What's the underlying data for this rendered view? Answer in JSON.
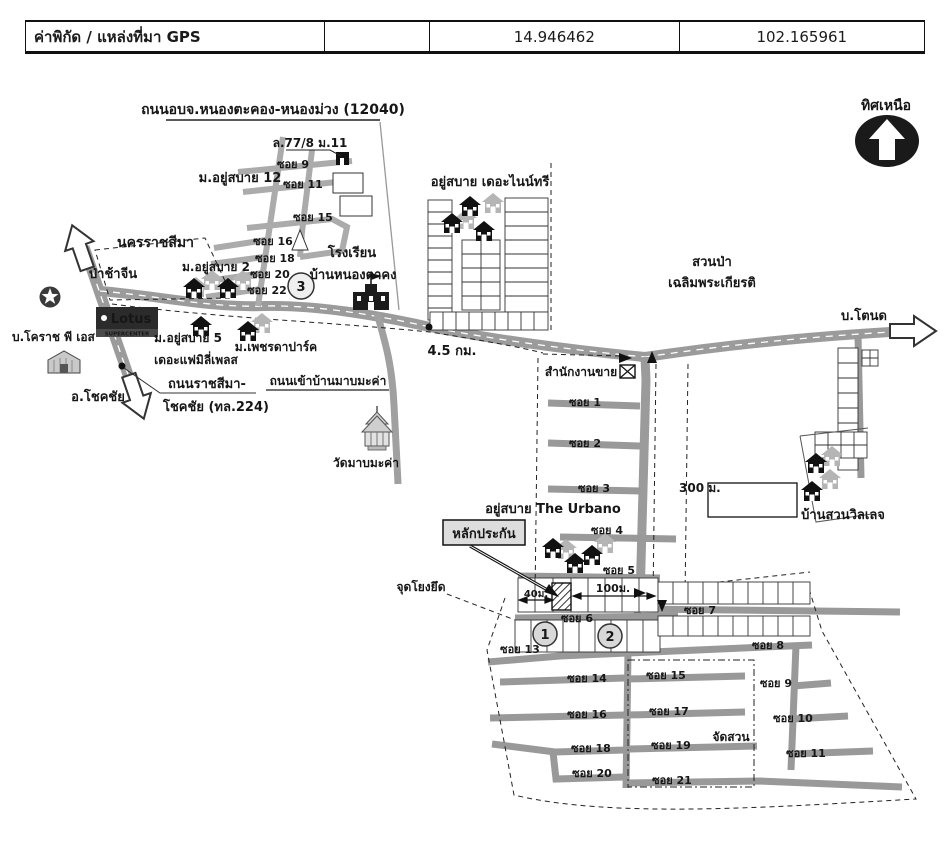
{
  "header": {
    "col1": "ค่าพิกัด / แหล่งที่มา GPS",
    "col2": "",
    "col3": "14.946462",
    "col4": "102.165961"
  },
  "compass": {
    "label": "ทิศเหนือ"
  },
  "roads": {
    "top_road": "ถนนอบจ.หนองตะคอง-หนองม่วง (12040)",
    "highway_label_1": "ถนนราชสีมา-",
    "highway_label_2": "โชคชัย (ทล.224)",
    "makha_entry": "ถนนเข้าบ้านมาบมะค่า"
  },
  "destinations": {
    "north_west": "นครราชสีมา",
    "south": "อ.โชคชัย",
    "east": "บ.โตนด"
  },
  "places": {
    "house_77": "ล.77/8 ม.11",
    "moo12": "ม.อยู่สบาย 12",
    "school_line1": "โรงเรียน",
    "school_line2": "บ้านหนองตาคง",
    "cemetery": "ป่าช้าจีน",
    "moo2": "ม.อยู่สบาย 2",
    "lotus": "Lotus",
    "lotus_sub": "SUPERCENTER",
    "korat_ps": "บ.โคราช พี เอส",
    "moo5_line1": "ม.อยู่สบาย 5",
    "moo5_line2": "เดอะแฟมิลี่เพลส",
    "phetda": "ม.เพชรดาปาร์ค",
    "wat": "วัดมาบมะค่า",
    "ninetree": "อยู่สบาย เดอะไนน์ทรี",
    "forest_line1": "สวนป่า",
    "forest_line2": "เฉลิมพระเกียรติ",
    "sales_office": "สำนักงานขาย",
    "urbano": "อยู่สบาย The Urbano",
    "collateral": "หลักประกัน",
    "anchor_point": "จุดโยงยึด",
    "garden": "จัดสวน",
    "baan_suan": "บ้านสวนวิลเลจ"
  },
  "distances": {
    "km45": "4.5 กม.",
    "m300": "300 ม.",
    "m40": "40ม.",
    "m100": "100ม."
  },
  "markers": {
    "n1": "1",
    "n2": "2",
    "n3": "3"
  },
  "sois": {
    "top": {
      "s9": "ซอย 9",
      "s11": "ซอย 11",
      "s15": "ซอย 15",
      "s16": "ซอย 16",
      "s18": "ซอย 18",
      "s20": "ซอย 20",
      "s22": "ซอย 22"
    },
    "mid": {
      "s1": "ซอย 1",
      "s2": "ซอย 2",
      "s3": "ซอย 3",
      "s4": "ซอย 4",
      "s5": "ซอย 5",
      "s6": "ซอย 6",
      "s7": "ซอย 7",
      "s8": "ซอย 8"
    },
    "bottom": {
      "s13": "ซอย 13",
      "s14": "ซอย 14",
      "s15": "ซอย 15",
      "s16": "ซอย 16",
      "s17": "ซอย 17",
      "s18": "ซอย 18",
      "s19": "ซอย 19",
      "s20": "ซอย 20",
      "s21": "ซอย 21",
      "s9": "ซอย 9",
      "s10": "ซอย 10",
      "s11": "ซอย 11"
    }
  },
  "colors": {
    "road": "#9b9b9b",
    "cluster_road": "#ababab",
    "ink": "#1a1a1a",
    "lotus_bg": "#2b2b2b"
  }
}
